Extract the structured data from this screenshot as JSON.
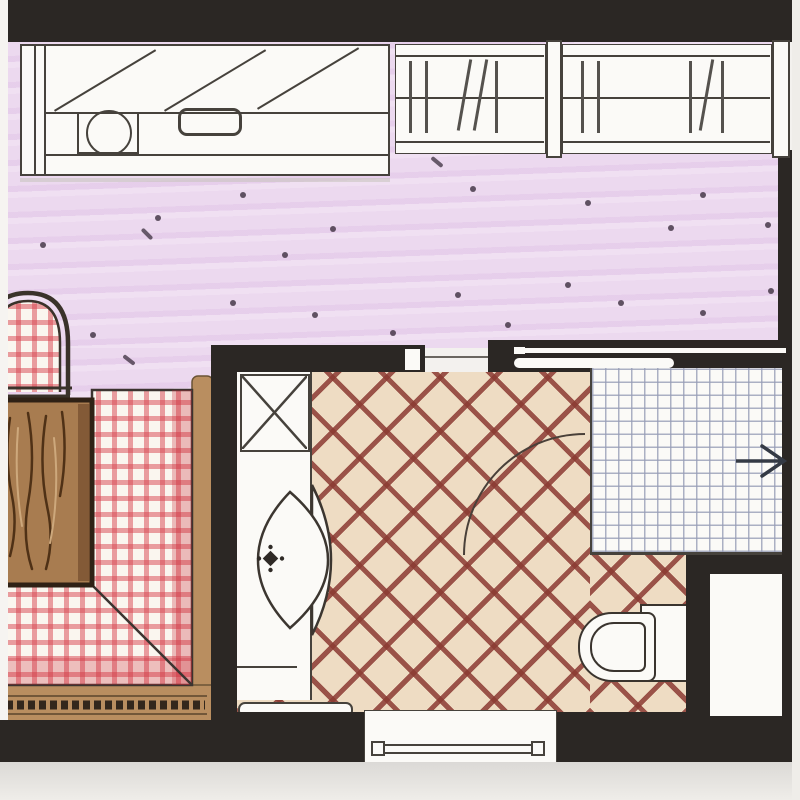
{
  "document": {
    "kind": "hand-drawn architectural floor plan sketch",
    "visible_text": [],
    "rooms": [
      {
        "name": "kitchen-living-area",
        "floor": "purple speckled screed"
      },
      {
        "name": "dining-nook",
        "floor": "red gingham corner bench with wooden table"
      },
      {
        "name": "bathroom",
        "floor": "diagonal red crosshatch tile"
      },
      {
        "name": "shower",
        "floor": "fine white grid tile"
      }
    ],
    "fixtures": [
      "kitchen-counter",
      "counter-sink",
      "counter-cooktop",
      "wall-cabinet-diagonals",
      "window-top-a",
      "window-top-b",
      "arch-chair",
      "dining-table",
      "corner-bench",
      "tall-cabinet-x",
      "vanity-basin",
      "faucet",
      "sliding-door",
      "door-swing-arc",
      "shower-arrow",
      "toilet",
      "radiator",
      "bottom-window",
      "wall-niche"
    ],
    "palette": {
      "paper": "#f3f1ee",
      "paper_band": "#dbd9d6",
      "wall": "#2b2724",
      "line": "#46423c",
      "purple": "#ecd9ef",
      "purple_streak": "#e0c2e6",
      "speckle": "#463849",
      "white": "#fbfaf7",
      "check_red": "#d8414e",
      "tan": "#b98e60",
      "braid": "#33271c",
      "wood": "#a87c50",
      "wood_dark": "#4f3116",
      "wood_edge": "#2f2115",
      "bath_floor": "#eedcc3",
      "hatch": "#8b3a32",
      "grid_line": "#a9aec2",
      "arrow": "#343a45"
    }
  }
}
